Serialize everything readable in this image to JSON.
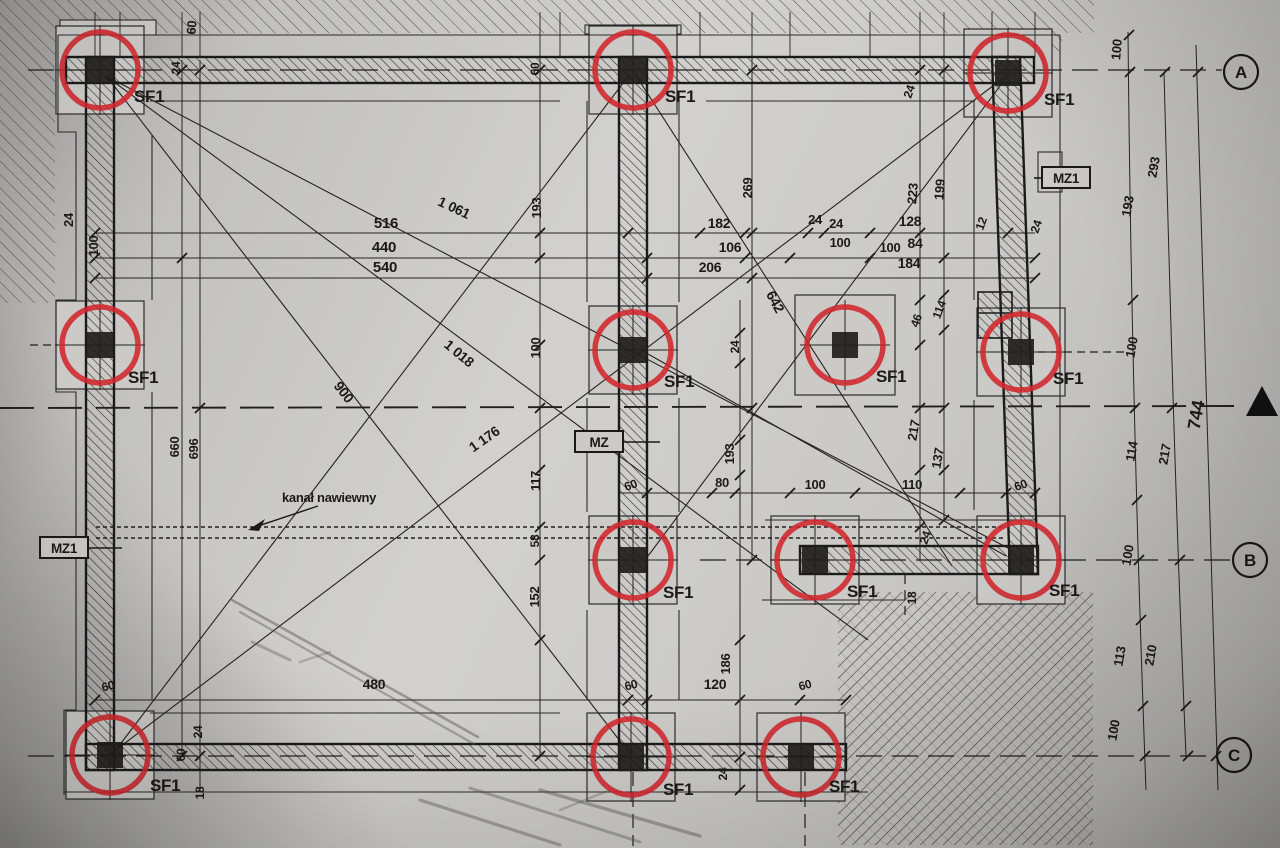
{
  "document": {
    "type": "scanned structural foundation plan",
    "language": "Polish",
    "column_mark": "SF1",
    "duct_annotation": "kanał nawiewny",
    "overall_dimension": "744"
  },
  "colors": {
    "marker_red": "#d2262c",
    "ink": "#1b1a18",
    "paper": "#cbcac7"
  },
  "grid_bubbles": [
    {
      "label": "A",
      "x": 1241,
      "y": 72
    },
    {
      "label": "B",
      "x": 1250,
      "y": 560
    },
    {
      "label": "C",
      "x": 1234,
      "y": 755
    }
  ],
  "wall_tags": [
    {
      "text": "MZ1",
      "x": 64,
      "y": 548
    },
    {
      "text": "MZ",
      "x": 599,
      "y": 442
    },
    {
      "text": "MZ1",
      "x": 1066,
      "y": 178
    }
  ],
  "columns": [
    {
      "x": 100,
      "y": 70,
      "lx": 134,
      "ly": 102
    },
    {
      "x": 633,
      "y": 70,
      "lx": 665,
      "ly": 102
    },
    {
      "x": 1008,
      "y": 73,
      "lx": 1044,
      "ly": 105
    },
    {
      "x": 100,
      "y": 345,
      "lx": 128,
      "ly": 383
    },
    {
      "x": 633,
      "y": 350,
      "lx": 664,
      "ly": 387
    },
    {
      "x": 845,
      "y": 345,
      "lx": 876,
      "ly": 382,
      "pad": 100
    },
    {
      "x": 1021,
      "y": 352,
      "lx": 1053,
      "ly": 384
    },
    {
      "x": 633,
      "y": 560,
      "lx": 663,
      "ly": 598
    },
    {
      "x": 815,
      "y": 560,
      "lx": 847,
      "ly": 597
    },
    {
      "x": 1021,
      "y": 560,
      "lx": 1049,
      "ly": 596
    },
    {
      "x": 110,
      "y": 755,
      "lx": 150,
      "ly": 791
    },
    {
      "x": 631,
      "y": 757,
      "lx": 663,
      "ly": 795
    },
    {
      "x": 801,
      "y": 757,
      "lx": 829,
      "ly": 792
    }
  ],
  "dim_labels": [
    {
      "t": "516",
      "x": 386,
      "y": 228,
      "s": 15
    },
    {
      "t": "440",
      "x": 384,
      "y": 252,
      "s": 15
    },
    {
      "t": "540",
      "x": 385,
      "y": 272,
      "s": 15
    },
    {
      "t": "1 061",
      "x": 452,
      "y": 212,
      "r": 25,
      "s": 14
    },
    {
      "t": "193",
      "x": 541,
      "y": 208,
      "r": -90
    },
    {
      "t": "24",
      "x": 836,
      "y": 228
    },
    {
      "t": "100",
      "x": 890,
      "y": 252
    },
    {
      "t": "182",
      "x": 719,
      "y": 228,
      "s": 14
    },
    {
      "t": "106",
      "x": 730,
      "y": 252,
      "s": 14
    },
    {
      "t": "206",
      "x": 710,
      "y": 272,
      "s": 14
    },
    {
      "t": "24",
      "x": 815,
      "y": 224
    },
    {
      "t": "100",
      "x": 840,
      "y": 247
    },
    {
      "t": "128",
      "x": 910,
      "y": 226,
      "s": 14
    },
    {
      "t": "84",
      "x": 915,
      "y": 248,
      "s": 14
    },
    {
      "t": "184",
      "x": 909,
      "y": 268,
      "s": 14
    },
    {
      "t": "269",
      "x": 752,
      "y": 188,
      "r": -90
    },
    {
      "t": "223",
      "x": 917,
      "y": 194,
      "r": -85
    },
    {
      "t": "199",
      "x": 944,
      "y": 190,
      "r": -85
    },
    {
      "t": "12",
      "x": 985,
      "y": 225,
      "r": -70,
      "s": 12
    },
    {
      "t": "24",
      "x": 1040,
      "y": 228,
      "r": -70,
      "s": 12
    },
    {
      "t": "60",
      "x": 196,
      "y": 28,
      "r": -85
    },
    {
      "t": "24",
      "x": 180,
      "y": 68,
      "r": -90,
      "s": 12
    },
    {
      "t": "24",
      "x": 73,
      "y": 220,
      "r": -90
    },
    {
      "t": "100",
      "x": 98,
      "y": 246,
      "r": -90
    },
    {
      "t": "60",
      "x": 539,
      "y": 69,
      "r": -90,
      "s": 12
    },
    {
      "t": "24",
      "x": 913,
      "y": 93,
      "r": -70,
      "s": 12
    },
    {
      "t": "100",
      "x": 1121,
      "y": 50,
      "r": -85
    },
    {
      "t": "293",
      "x": 1158,
      "y": 168,
      "r": -80
    },
    {
      "t": "193",
      "x": 1132,
      "y": 207,
      "r": -80
    },
    {
      "t": "100",
      "x": 1136,
      "y": 348,
      "r": -80
    },
    {
      "t": "114",
      "x": 1136,
      "y": 452,
      "r": -80
    },
    {
      "t": "217",
      "x": 1169,
      "y": 455,
      "r": -80
    },
    {
      "t": "744",
      "x": 1202,
      "y": 416,
      "r": -80,
      "s": 18
    },
    {
      "t": "100",
      "x": 1132,
      "y": 556,
      "r": -80
    },
    {
      "t": "113",
      "x": 1124,
      "y": 657,
      "r": -80
    },
    {
      "t": "210",
      "x": 1155,
      "y": 656,
      "r": -80
    },
    {
      "t": "100",
      "x": 1118,
      "y": 731,
      "r": -80
    },
    {
      "t": "660",
      "x": 179,
      "y": 447,
      "r": -90
    },
    {
      "t": "696",
      "x": 198,
      "y": 449,
      "r": -90
    },
    {
      "t": "900",
      "x": 340,
      "y": 395,
      "r": 52,
      "s": 14
    },
    {
      "t": "1 018",
      "x": 456,
      "y": 357,
      "r": 40,
      "s": 14
    },
    {
      "t": "1 176",
      "x": 487,
      "y": 443,
      "r": -35,
      "s": 14
    },
    {
      "t": "642",
      "x": 771,
      "y": 304,
      "r": 62,
      "s": 14
    },
    {
      "t": "100",
      "x": 540,
      "y": 348,
      "r": -90
    },
    {
      "t": "117",
      "x": 540,
      "y": 481,
      "r": -90
    },
    {
      "t": "58",
      "x": 539,
      "y": 541,
      "r": -90,
      "s": 12
    },
    {
      "t": "152",
      "x": 539,
      "y": 597,
      "r": -90
    },
    {
      "t": "24",
      "x": 739,
      "y": 347,
      "r": -90,
      "s": 12
    },
    {
      "t": "193",
      "x": 734,
      "y": 454,
      "r": -90
    },
    {
      "t": "80",
      "x": 722,
      "y": 487
    },
    {
      "t": "100",
      "x": 815,
      "y": 489
    },
    {
      "t": "110",
      "x": 912,
      "y": 489
    },
    {
      "t": "60",
      "x": 632,
      "y": 489,
      "r": -20,
      "s": 12
    },
    {
      "t": "60",
      "x": 1022,
      "y": 489,
      "r": -20,
      "s": 12
    },
    {
      "t": "46",
      "x": 920,
      "y": 322,
      "r": -70,
      "s": 12
    },
    {
      "t": "114",
      "x": 943,
      "y": 311,
      "r": -70,
      "s": 12
    },
    {
      "t": "217",
      "x": 918,
      "y": 431,
      "r": -80
    },
    {
      "t": "137",
      "x": 942,
      "y": 459,
      "r": -80
    },
    {
      "t": "24",
      "x": 929,
      "y": 539,
      "r": -70,
      "s": 12
    },
    {
      "t": "18",
      "x": 916,
      "y": 598,
      "r": -90,
      "s": 12
    },
    {
      "t": "186",
      "x": 730,
      "y": 664,
      "r": -90
    },
    {
      "t": "120",
      "x": 715,
      "y": 689,
      "s": 14
    },
    {
      "t": "480",
      "x": 374,
      "y": 689,
      "s": 14
    },
    {
      "t": "60",
      "x": 109,
      "y": 690,
      "r": -15,
      "s": 12
    },
    {
      "t": "24",
      "x": 202,
      "y": 732,
      "r": -90,
      "s": 12
    },
    {
      "t": "60",
      "x": 185,
      "y": 755,
      "r": -90,
      "s": 12
    },
    {
      "t": "18",
      "x": 204,
      "y": 793,
      "r": -90,
      "s": 12
    },
    {
      "t": "60",
      "x": 632,
      "y": 689,
      "r": -15,
      "s": 12
    },
    {
      "t": "60",
      "x": 806,
      "y": 689,
      "r": -15,
      "s": 12
    },
    {
      "t": "24",
      "x": 727,
      "y": 774,
      "r": -90,
      "s": 12
    }
  ]
}
